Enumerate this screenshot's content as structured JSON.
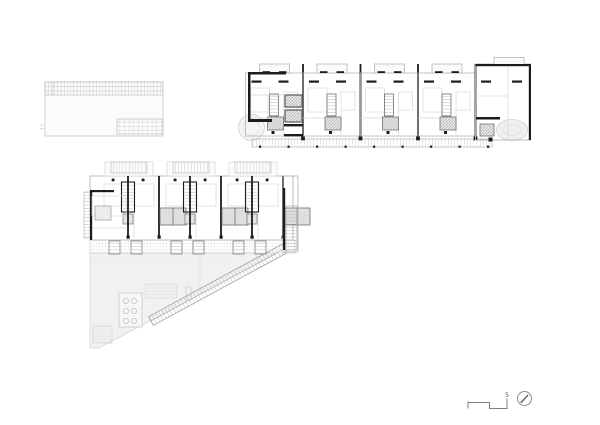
{
  "document": {
    "kind": "architectural-floor-plan-sheet",
    "background": "#ffffff"
  },
  "plans": {
    "roof_plan": {
      "label": "roof-plan",
      "position": "top-left"
    },
    "typical_floor_plan": {
      "label": "typical-floor-plan",
      "position": "top-right",
      "repeated_units": 4
    },
    "ground_floor_plan": {
      "label": "ground-floor-plan",
      "position": "middle-left",
      "repeated_units": 3,
      "has_plaza_triangle": true
    }
  },
  "legend": {
    "scale_label": "5",
    "north_icon": "compass-north-arrow"
  },
  "colors": {
    "line_dark": "#1c1c1c",
    "line_mid": "#6f6f6f",
    "line_light": "#b5b5b5",
    "line_faint": "#d8d8d8",
    "fill_page": "#ffffff",
    "fill_soft": "#fbfbfb",
    "fill_plaza": "#f1f1f1",
    "fill_hatch": "#e5e5e5",
    "label_color": "#555555"
  }
}
